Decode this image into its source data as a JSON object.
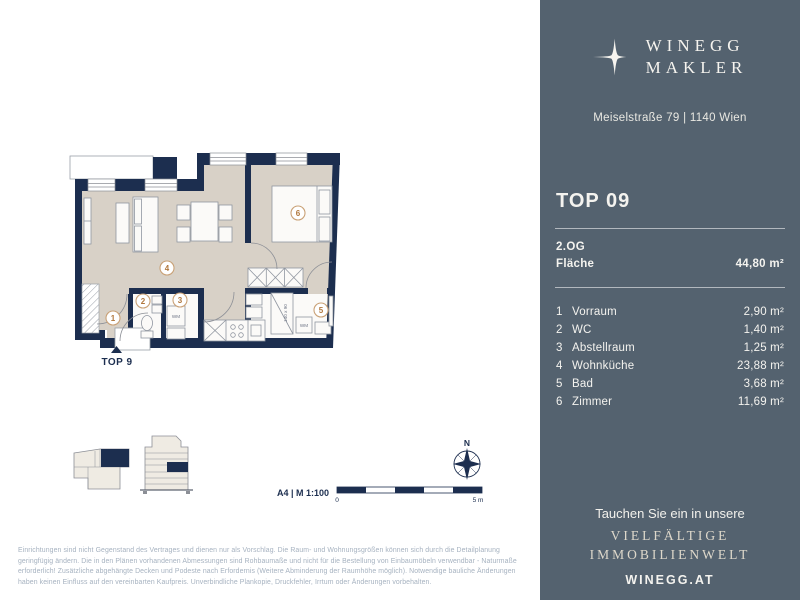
{
  "brand": {
    "name_line1": "WINEGG",
    "name_line2": "MAKLER",
    "address": "Meiselstraße 79 | 1140 Wien"
  },
  "unit": {
    "title": "TOP 09",
    "floor": "2.OG",
    "area_label": "Fläche",
    "area_value": "44,80 m²"
  },
  "rooms": [
    {
      "nr": "1",
      "name": "Vorraum",
      "area": "2,90 m²"
    },
    {
      "nr": "2",
      "name": "WC",
      "area": "1,40 m²"
    },
    {
      "nr": "3",
      "name": "Abstellraum",
      "area": "1,25 m²"
    },
    {
      "nr": "4",
      "name": "Wohnküche",
      "area": "23,88 m²"
    },
    {
      "nr": "5",
      "name": "Bad",
      "area": "3,68 m²"
    },
    {
      "nr": "6",
      "name": "Zimmer",
      "area": "11,69 m²"
    }
  ],
  "plan": {
    "entrance_label": "TOP 9",
    "wm_label": "WM",
    "shower_dim": "140 x 90",
    "compass_north": "N",
    "scale_label": "A4 | M 1:100",
    "scale_start": "0",
    "scale_end": "5 m"
  },
  "footer": {
    "line1": "Tauchen Sie ein in unsere",
    "line2": "VIELFÄLTIGE",
    "line3": "IMMOBILIENWELT",
    "website": "WINEGG.AT"
  },
  "disclaimer": "Einrichtungen sind nicht Gegenstand des Vertrages und dienen nur als Vorschlag. Die Raum- und Wohnungsgrößen können sich durch die Detailplanung geringfügig ändern. Die in den Plänen vorhandenen Abmessungen sind Rohbaumaße und nicht für die Bestellung von Einbaumöbeln verwendbar - Naturmaße erforderlich! Zusätzliche abgehängte Decken und Podeste nach Erfordernis (Weitere Abminderung der Raumhöhe möglich). Notwendige bauliche Änderungen haben keinen Einfluss auf den vereinbarten Kaufpreis. Unverbindliche Plankopie, Druckfehler, Irrtum oder Änderungen vorbehalten.",
  "colors": {
    "panel": "#54626f",
    "wall": "#1c2e4f",
    "floor": "#d8d1c7",
    "circle_stroke": "#c9a176",
    "circle_number": "#b0763b",
    "cream": "#ded8cb"
  }
}
